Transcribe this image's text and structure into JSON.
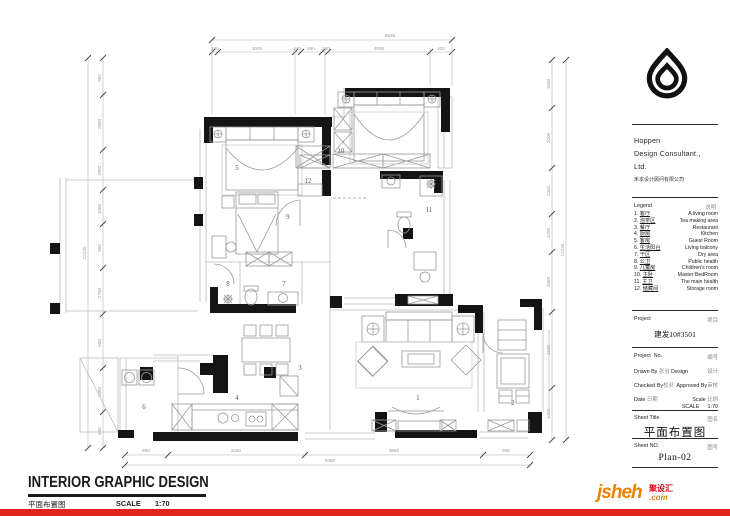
{
  "sidebar": {
    "company": {
      "line1": "Hoppen",
      "line2": "Design Consultant.,",
      "line3": "Ltd.",
      "cn": "禾本设计顾问有限公司"
    },
    "legend": {
      "title": "Legend",
      "title_cn": "说明",
      "items": [
        {
          "no": "1.",
          "cn": "客厅",
          "en": "A living room"
        },
        {
          "no": "2.",
          "cn": "泡茶区",
          "en": "Tea making area"
        },
        {
          "no": "3.",
          "cn": "餐厅",
          "en": "Restaurant"
        },
        {
          "no": "4.",
          "cn": "厨房",
          "en": "Kitchen"
        },
        {
          "no": "5.",
          "cn": "客房",
          "en": "Guest Room"
        },
        {
          "no": "6.",
          "cn": "生活阳台",
          "en": "Living balcony"
        },
        {
          "no": "7.",
          "cn": "干区",
          "en": "Dry area"
        },
        {
          "no": "8.",
          "cn": "公卫",
          "en": "Public health"
        },
        {
          "no": "9.",
          "cn": "儿童房",
          "en": "Children's room"
        },
        {
          "no": "10.",
          "cn": "主卧",
          "en": "Master BedRoom"
        },
        {
          "no": "11.",
          "cn": "主卫",
          "en": "The main health"
        },
        {
          "no": "12.",
          "cn": "储藏间",
          "en": "Storage room"
        }
      ]
    },
    "project": {
      "label": "Project",
      "label_cn": "项目",
      "name": "建发10#3501"
    },
    "info": {
      "no_label": "Project",
      "no_label2": "No.",
      "no_cn": "编号",
      "drawn_label": "Drawn By",
      "drawn_name": "张治",
      "design_label": "Design",
      "design_cn": "设计",
      "checked_label": "Checked By",
      "checked_cn": "校对",
      "approved_label": "Approved By",
      "approved_cn": "审核",
      "date_label": "Date",
      "date_cn": "日期",
      "scale_label": "Scale",
      "scale_cn": "比例",
      "scale_caps": "SCALE",
      "scale_value": "1:70"
    },
    "sheet": {
      "title_label": "Sheet  Title",
      "title_cn": "图名",
      "title_value": "平面布置图",
      "no_label": "Sheet  NO.",
      "no_cn": "图号",
      "no_value": "Plan-02"
    }
  },
  "footer": {
    "title": "INTERIOR GRAPHIC DESIGN",
    "subtitle": "平面布置图",
    "scale_label": "SCALE",
    "scale_value": "1:70"
  },
  "brand": {
    "logo_text": "jsheh",
    "logo_suffix": ".com",
    "logo_cn": "聚设汇",
    "orange": "#f08200",
    "red": "#e60012",
    "bar_color": "#e1251b"
  },
  "plan": {
    "rooms": [
      "1",
      "2",
      "3",
      "4",
      "5",
      "6",
      "7",
      "8",
      "9",
      "10",
      "11",
      "12"
    ],
    "dims": {
      "top_total": "9635",
      "top_segments": [
        "240",
        "3045",
        "240",
        "650",
        "240",
        "4000",
        "820"
      ],
      "bottom_total": "9480",
      "bottom_segments": [
        "890",
        "3260",
        "3860",
        "935"
      ],
      "left_total": "12230",
      "left_segments": [
        "950",
        "2850",
        "1950",
        "1060",
        "950",
        "2750",
        "900",
        "1460",
        "540"
      ],
      "right_total": "12230",
      "right_segments": [
        "1650",
        "2000",
        "1300",
        "1280",
        "2080",
        "2600",
        "1000"
      ]
    }
  }
}
